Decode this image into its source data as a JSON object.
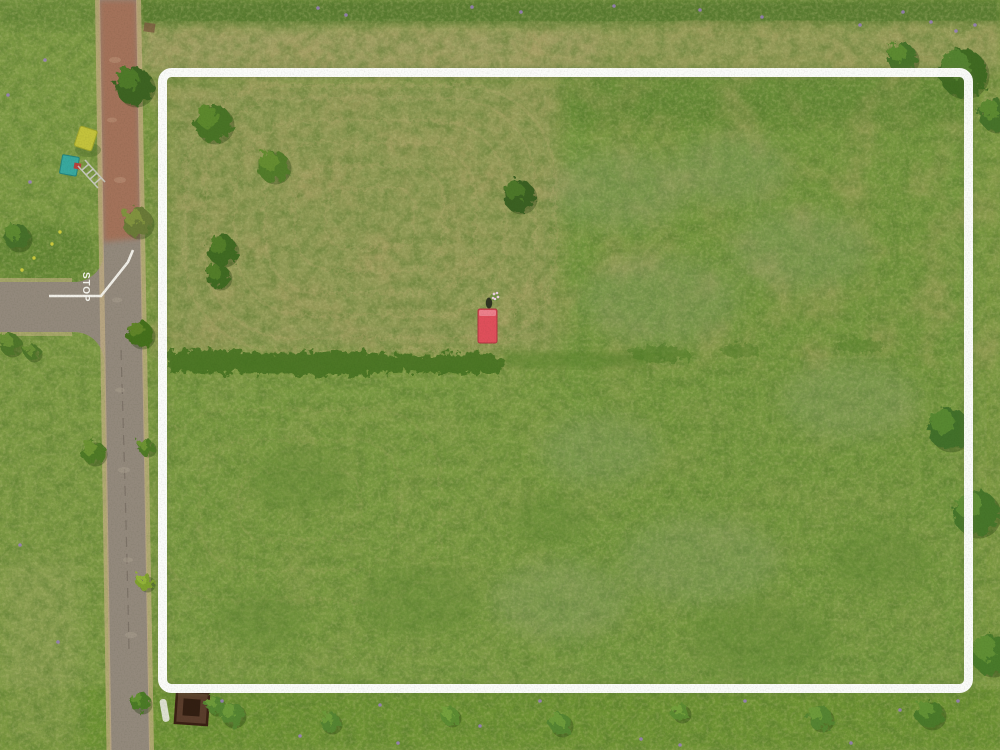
{
  "meta": {
    "title": "Aerial drone view of a vacant grass land parcel outlined with a white boundary, road on the left"
  },
  "annotation": {
    "boundary_color": "#ffffff",
    "boundary_stroke": 9
  },
  "road": {
    "stop_marking": "STOP",
    "marking_color": "#f5f4ee",
    "asphalt_color": "#93897c",
    "dirt_color": "#a3725a",
    "shoulder_color": "#c6b185"
  },
  "field": {
    "base_color": "#7d9a44",
    "mowed_tint": "#9b9c60",
    "hedge_color": "#477320",
    "top_strip_color": "#5a7c33",
    "tan_band_color": "#a49f68"
  },
  "objects": {
    "trailer": {
      "label": "red-trailer",
      "color": "#df4f5b",
      "accent": "#ee8490"
    },
    "tent": {
      "label": "yellow-tent",
      "color": "#c3c23c"
    },
    "container": {
      "label": "teal-container",
      "color": "#38a89e"
    },
    "ladder": {
      "color": "#c9c9bf"
    },
    "pit": {
      "color": "#5a3d2c"
    },
    "person": {
      "color": "#2f3422"
    }
  },
  "vegetation": {
    "flower_color": "#9a7fc0",
    "yellow_flower_color": "#d8d23e",
    "trees": [
      {
        "x": 134,
        "y": 86,
        "r": 19,
        "c1": "#3c6322",
        "c2": "#517d2c"
      },
      {
        "x": 137,
        "y": 222,
        "r": 15,
        "c1": "#6a7a38",
        "c2": "#84953f"
      },
      {
        "x": 140,
        "y": 334,
        "r": 13,
        "c1": "#45701f",
        "c2": "#63862c"
      },
      {
        "x": 93,
        "y": 452,
        "r": 12,
        "c1": "#4f7a28",
        "c2": "#6f9635"
      },
      {
        "x": 146,
        "y": 447,
        "r": 8,
        "c1": "#4f7a28",
        "c2": "#6f9635"
      },
      {
        "x": 17,
        "y": 237,
        "r": 13,
        "c1": "#47702a",
        "c2": "#618c33"
      },
      {
        "x": 10,
        "y": 344,
        "r": 11,
        "c1": "#50762c",
        "c2": "#6d9237"
      },
      {
        "x": 32,
        "y": 352,
        "r": 8,
        "c1": "#50762c",
        "c2": "#6d9237"
      },
      {
        "x": 145,
        "y": 582,
        "r": 8,
        "c1": "#7fa02e",
        "c2": "#95b53a"
      },
      {
        "x": 140,
        "y": 702,
        "r": 10,
        "c1": "#4c7a26",
        "c2": "#659331"
      },
      {
        "x": 213,
        "y": 123,
        "r": 19,
        "c1": "#497326",
        "c2": "#5f8a2f"
      },
      {
        "x": 273,
        "y": 166,
        "r": 16,
        "c1": "#527c29",
        "c2": "#688f33"
      },
      {
        "x": 222,
        "y": 250,
        "r": 15,
        "c1": "#3f6a20",
        "c2": "#547f2a"
      },
      {
        "x": 218,
        "y": 276,
        "r": 12,
        "c1": "#3f6a20",
        "c2": "#547f2a"
      },
      {
        "x": 519,
        "y": 196,
        "r": 16,
        "c1": "#3a6120",
        "c2": "#4f7a2a"
      },
      {
        "x": 963,
        "y": 73,
        "r": 24,
        "c1": "#3f6b24",
        "c2": "#578531"
      },
      {
        "x": 995,
        "y": 115,
        "r": 16,
        "c1": "#47732a",
        "c2": "#5f8c33"
      },
      {
        "x": 902,
        "y": 58,
        "r": 15,
        "c1": "#47732a",
        "c2": "#5f8c33"
      },
      {
        "x": 949,
        "y": 429,
        "r": 21,
        "c1": "#427029",
        "c2": "#5a8b33"
      },
      {
        "x": 976,
        "y": 513,
        "r": 23,
        "c1": "#47762c",
        "c2": "#639239"
      },
      {
        "x": 991,
        "y": 655,
        "r": 20,
        "c1": "#4a7a2a",
        "c2": "#629135"
      },
      {
        "x": 215,
        "y": 705,
        "r": 9,
        "c1": "#568530",
        "c2": "#6f9c3a"
      },
      {
        "x": 232,
        "y": 714,
        "r": 12,
        "c1": "#568530",
        "c2": "#6f9c3a"
      },
      {
        "x": 330,
        "y": 722,
        "r": 10,
        "c1": "#568530",
        "c2": "#6f9c3a"
      },
      {
        "x": 450,
        "y": 716,
        "r": 9,
        "c1": "#5d8c33",
        "c2": "#76a23d"
      },
      {
        "x": 560,
        "y": 724,
        "r": 11,
        "c1": "#568530",
        "c2": "#6f9c3a"
      },
      {
        "x": 680,
        "y": 712,
        "r": 9,
        "c1": "#5d8c33",
        "c2": "#76a23d"
      },
      {
        "x": 820,
        "y": 718,
        "r": 12,
        "c1": "#568530",
        "c2": "#6f9c3a"
      },
      {
        "x": 930,
        "y": 714,
        "r": 14,
        "c1": "#4c7a29",
        "c2": "#659336"
      }
    ],
    "purple_flowers": [
      [
        318,
        8
      ],
      [
        346,
        15
      ],
      [
        472,
        7
      ],
      [
        521,
        12
      ],
      [
        700,
        10
      ],
      [
        762,
        17
      ],
      [
        931,
        22
      ],
      [
        956,
        31
      ],
      [
        903,
        12
      ],
      [
        614,
        6
      ],
      [
        860,
        25
      ],
      [
        975,
        25
      ],
      [
        222,
        701
      ],
      [
        300,
        736
      ],
      [
        398,
        743
      ],
      [
        540,
        701
      ],
      [
        641,
        739
      ],
      [
        745,
        701
      ],
      [
        851,
        743
      ],
      [
        958,
        701
      ],
      [
        380,
        705
      ],
      [
        480,
        726
      ],
      [
        680,
        745
      ],
      [
        900,
        710
      ],
      [
        30,
        182
      ],
      [
        20,
        545
      ],
      [
        58,
        642
      ],
      [
        8,
        95
      ],
      [
        45,
        60
      ]
    ],
    "yellow_flowers": [
      [
        34,
        258
      ],
      [
        52,
        244
      ],
      [
        22,
        270
      ],
      [
        60,
        232
      ]
    ]
  },
  "field_pattern": {
    "color": "#b8ac72",
    "sets": [
      {
        "cx": 370,
        "cy": 218,
        "opacity": 0.25,
        "rings": [
          [
            90,
            60
          ],
          [
            150,
            105
          ],
          [
            210,
            150
          ],
          [
            270,
            195
          ],
          [
            330,
            240
          ],
          [
            370,
            265
          ]
        ]
      },
      {
        "cx": 300,
        "cy": 505,
        "opacity": 0.12,
        "rings": [
          [
            120,
            70
          ],
          [
            200,
            130
          ],
          [
            280,
            190
          ]
        ]
      }
    ]
  }
}
